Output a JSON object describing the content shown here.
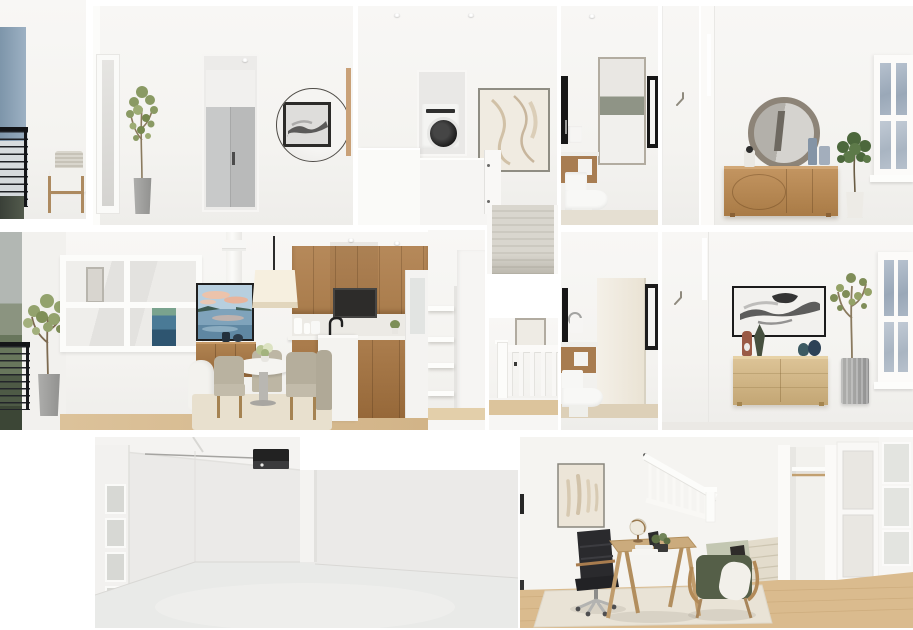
{
  "scene": {
    "type": "3d-dollhouse-floorplan-render",
    "description": "Cutaway interior rendering of a three-level furnished townhome shown as separate room panels on a white background",
    "rooms": [
      {
        "name": "upper-balcony",
        "objects": [
          "blue accent wall",
          "black cable railing",
          "wood armchair with white cushion and striped pillow",
          "dark balcony floor"
        ]
      },
      {
        "name": "upper-hallway",
        "objects": [
          "leaning floor mirror",
          "potted tree in concrete planter",
          "recessed gray closet doors with dark handle",
          "round mirror reflecting black-framed artwork",
          "wood trim strip"
        ]
      },
      {
        "name": "laundry-hall",
        "objects": [
          "ceiling recessed lights",
          "stacked front-load washer in alcove",
          "framed beige abstract art",
          "white half walls",
          "white door edge"
        ]
      },
      {
        "name": "upper-bathroom",
        "objects": [
          "vanity mirror reflecting bed with green headboard",
          "towel ring with towel",
          "wood vanity with white sink front",
          "toilet",
          "black framed door edges"
        ]
      },
      {
        "name": "upper-hall-nook",
        "objects": [
          "wall hook"
        ]
      },
      {
        "name": "upper-bedroom",
        "objects": [
          "round wood-framed mirror",
          "fluted wood dresser",
          "lidded jar",
          "blue-gray vases",
          "potted plant in white pot",
          "window with blue-gray panes"
        ]
      },
      {
        "name": "living-dining-kitchen",
        "objects": [
          "balcony greenery sliver",
          "black cable railing",
          "olive tree in concrete pot",
          "interior window wall",
          "blue-green framed painting",
          "wall TV showing lake sunset photo",
          "wood media console",
          "white pouf",
          "cream drum pendant light",
          "round white pedestal dining table",
          "green hydrangea centerpiece",
          "beige upholstered dining chairs",
          "beige area rug",
          "wood upper cabinets",
          "built-in dark wall oven",
          "white backsplash and counter",
          "wood lower cabinets",
          "white island",
          "black faucet",
          "white pitchers",
          "white pilaster column",
          "wood floor"
        ]
      },
      {
        "name": "linen-closet",
        "objects": [
          "four white shelves",
          "white cabinet panel",
          "wood floor strip"
        ]
      },
      {
        "name": "staircase-carpet",
        "objects": [
          "gray-beige carpeted stair flight",
          "white stringers"
        ]
      },
      {
        "name": "stairwell",
        "objects": [
          "framed art partial",
          "white banister with square balusters",
          "newel post",
          "wood floor strip"
        ]
      },
      {
        "name": "main-bathroom",
        "objects": [
          "black framed mirror edge",
          "towel ring with towel",
          "wood vanity",
          "toilet",
          "open cream door",
          "black framed mirror",
          "beige tile floor"
        ]
      },
      {
        "name": "main-bedroom",
        "objects": [
          "wall hook",
          "black-framed ink-wash artwork",
          "light oak six-drawer dresser",
          "rust figurine",
          "dark leaf sculpture",
          "teal and navy vases",
          "tall olive tree in ribbed gray planter",
          "window with blue-gray panes"
        ]
      },
      {
        "name": "garage",
        "objects": [
          "ceiling garage door opener with rail",
          "sectional garage door with frosted windows",
          "empty gray concrete floor",
          "wall column"
        ]
      },
      {
        "name": "office-den",
        "objects": [
          "framed beige figure art",
          "black tufted office chair with chrome star base",
          "angled wood writing desk",
          "white globe",
          "dark tablet",
          "potted plant in black bowl",
          "green armchair with sage cushion and white sherpa pillow",
          "white stair banister",
          "carpeted stairs",
          "open closet with shelf and rod",
          "white glass-panel doors",
          "oak floor",
          "cream area rug"
        ]
      }
    ]
  },
  "palette": {
    "pageBackground": "#ffffff",
    "wall": "#f5f4f1",
    "wallShadow": "#e9e8e5",
    "accentWallBlue": "#8ba3b8",
    "railingBlack": "#17181b",
    "woodCabinet": "#ab7d4d",
    "woodDresserOak": "#c09261",
    "woodLightOak": "#d4ba8b",
    "woodFloor": "#d9bb8e",
    "carpet": "#d5d1c8",
    "windowGlassBlue": "#a9b5c3",
    "plantGreen": "#8a9a64",
    "plantDarkGreen": "#4c683c",
    "concretePot": "#a0a09e",
    "upholsteryBeige": "#b9b2a0",
    "armchairGreen": "#55604a",
    "officeChairBlack": "#2a2a2d",
    "pendantCream": "#f4ead8",
    "tvSky": "#b7cfdf",
    "tvWater": "#6f93ad",
    "artInk": "#222222",
    "mirrorFrameGrayWood": "#8d8478",
    "rugCream": "#e9e3d6",
    "vanityWood": "#a87c50",
    "applianceDark": "#2d2c2a"
  }
}
